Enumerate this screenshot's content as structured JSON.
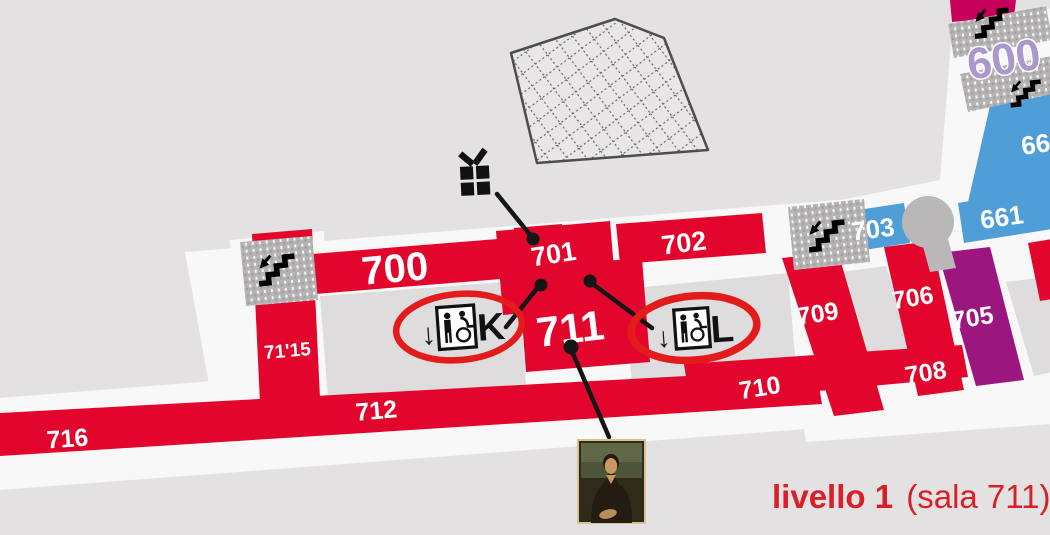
{
  "page": {
    "background_color": "#e3e1e2",
    "floor_color": "#f9f8f8",
    "courtyard_color": "#dedcdd"
  },
  "palette": {
    "room_red": "#e2062c",
    "room_blue": "#4f9ed7",
    "room_purple": "#9b167e",
    "room_magenta": "#c7005c",
    "level600_lavender": "#ab97cc",
    "stair_gray": "#b5b3b4",
    "annotation_red": "#e31b1b",
    "line_black": "#141414",
    "caption_red": "#d92027"
  },
  "rooms": {
    "r700": "700",
    "r701": "701",
    "r702": "702",
    "r711": "711",
    "r7115": "71'15",
    "r712": "712",
    "r716": "716",
    "r710": "710",
    "r708": "708",
    "r709": "709",
    "r706": "706",
    "r705": "705",
    "r703": "703",
    "r661": "661",
    "r662": "662",
    "r600": "600"
  },
  "markers": {
    "elevator_k": {
      "arrow": "↓",
      "letter": "K"
    },
    "elevator_l": {
      "arrow": "↓",
      "letter": "L"
    },
    "icons": {
      "gift": "gift-shop-icon",
      "stairs": "stairs-icon",
      "wheelchair_elevator": "accessible-elevator-icon",
      "mona_lisa": "mona-lisa-painting",
      "pyramid": "louvre-glass-pyramid"
    }
  },
  "caption": {
    "bold": "livello 1",
    "regular": " (sala 711)"
  }
}
